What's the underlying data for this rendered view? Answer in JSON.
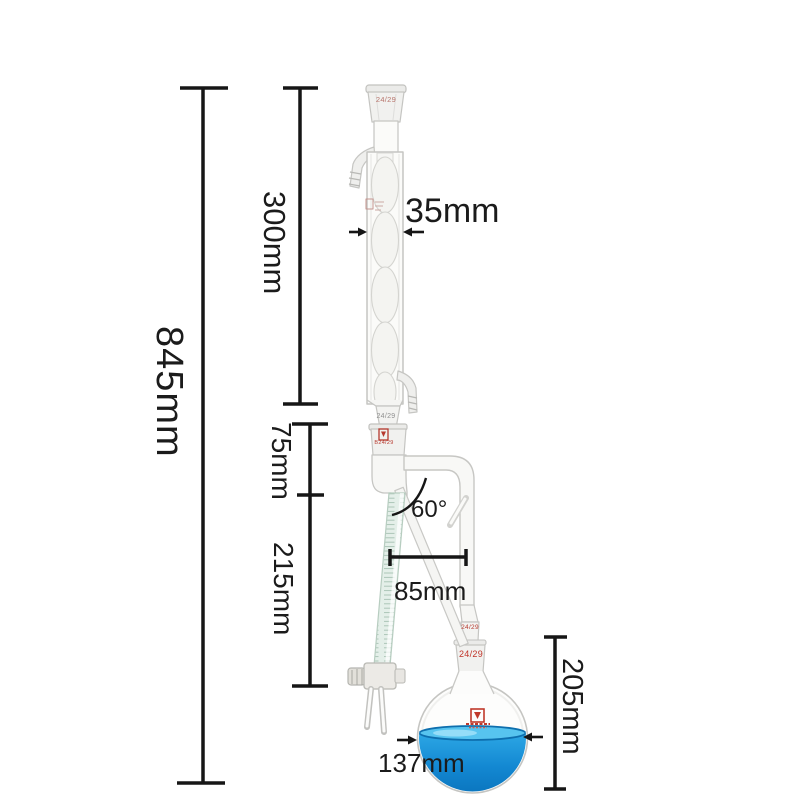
{
  "scene": {
    "description": "Dimensioned product photo of a glass distillation apparatus: Allihn condenser, 60-degree graduated distilling receiver with stopcock, and round-bottom flask with blue liquid",
    "background": "#ffffff"
  },
  "dimensions": {
    "overall_height": "845mm",
    "condenser_length": "300mm",
    "condenser_width": "35mm",
    "adapter_section": "75mm",
    "receiver_tube": "215mm",
    "branch_angle": "60°",
    "branch_width": "85mm",
    "flask_section_height": "205mm",
    "flask_diameter": "137mm"
  },
  "joints": {
    "condenser_top": "24/29",
    "condenser_bottom": "24/29",
    "receiver_socket": "B24/29",
    "flask_cone": "24/29",
    "flask_socket": "24/29"
  },
  "colors": {
    "dimension_ink": "#161616",
    "glass_outline": "#c5c5c2",
    "glass_fill": "#fbfbf9",
    "graduated_tube": "#e4efe9",
    "graduation_line": "#a6c2b2",
    "joint_red": "#b6392e",
    "liquid_surface": "#57c4ef",
    "liquid_mid": "#1e97dc",
    "liquid_deep": "#0c83cb"
  }
}
